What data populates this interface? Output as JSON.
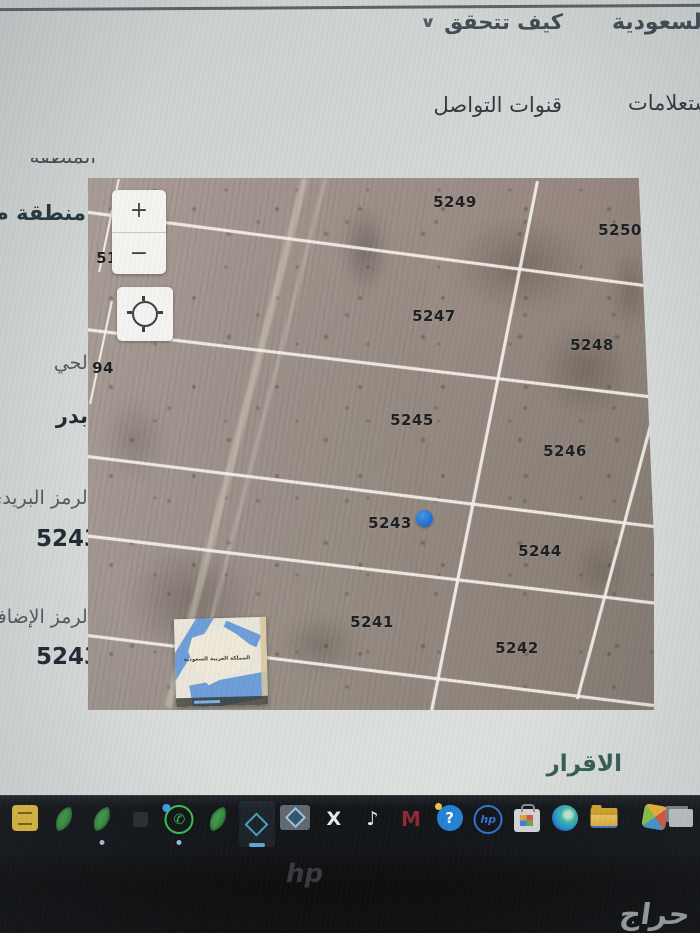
{
  "top_bar": {
    "brand_partial": "السعودية",
    "how_to_verify": "كيف تتحقق",
    "chevron": "∨"
  },
  "nav": {
    "inquiries": "استعلامات",
    "contact_channels": "قنوات التواصل"
  },
  "info_panel": {
    "region_label_partial": "المنطقة",
    "region_value_partial": "منطقة م",
    "fields": [
      {
        "label": "الحي",
        "value": "بدر"
      },
      {
        "label": "الرمز البريدي",
        "value": "5243"
      },
      {
        "label": "الرمز الإضافي",
        "value": "5243"
      }
    ]
  },
  "map": {
    "zoom_in": "+",
    "zoom_out": "−",
    "parcels": [
      {
        "id": "5249",
        "x": 455,
        "y": 202
      },
      {
        "id": "5250",
        "x": 620,
        "y": 230
      },
      {
        "id": "5247",
        "x": 434,
        "y": 316
      },
      {
        "id": "5248",
        "x": 592,
        "y": 345
      },
      {
        "id": "5245",
        "x": 412,
        "y": 420
      },
      {
        "id": "5246",
        "x": 565,
        "y": 451
      },
      {
        "id": "5243",
        "x": 390,
        "y": 523
      },
      {
        "id": "5244",
        "x": 540,
        "y": 551
      },
      {
        "id": "5241",
        "x": 372,
        "y": 622
      },
      {
        "id": "5242",
        "x": 517,
        "y": 648
      },
      {
        "id": "51",
        "x": 107,
        "y": 258
      },
      {
        "id": "94",
        "x": 103,
        "y": 368
      }
    ],
    "marker": {
      "x": 424,
      "y": 518,
      "color": "#1d6fd1"
    },
    "inset_label": "المملكة العربية السعودية"
  },
  "declaration": {
    "heading": "الاقرار"
  },
  "taskbar": {
    "icons": [
      {
        "name": "notes-app-icon",
        "type": "note"
      },
      {
        "name": "leaf-app-icon",
        "type": "leaf"
      },
      {
        "name": "leaf-app-icon-2",
        "type": "leaf",
        "running": true
      },
      {
        "name": "dim-app-icon",
        "type": "dim"
      },
      {
        "name": "whatsapp-icon",
        "type": "wa",
        "glyph": "✆",
        "running": true,
        "badge": true
      },
      {
        "name": "leaf-app-icon-3",
        "type": "leaf"
      },
      {
        "name": "diamond-active-app-icon",
        "type": "tile",
        "active": true
      },
      {
        "name": "diamond-grey-app-icon",
        "type": "gdiamond"
      },
      {
        "name": "x-app-icon",
        "type": "glyph",
        "glyph": "X"
      },
      {
        "name": "tiktok-icon",
        "type": "glyph",
        "glyph": "♪"
      },
      {
        "name": "m-app-icon",
        "type": "glyphred",
        "glyph": "M"
      },
      {
        "name": "hp-support-icon",
        "type": "q",
        "glyph": "?"
      },
      {
        "name": "hp-app-icon",
        "type": "hp",
        "glyph": "hp"
      },
      {
        "name": "store-icon",
        "type": "store"
      },
      {
        "name": "edge-icon",
        "type": "edge"
      },
      {
        "name": "file-explorer-icon",
        "type": "folder"
      },
      {
        "name": "photos-icon",
        "type": "pinwheel"
      },
      {
        "name": "window-app-icon",
        "type": "window"
      }
    ]
  },
  "watermark": "حراج",
  "laptop_logo": "hp"
}
